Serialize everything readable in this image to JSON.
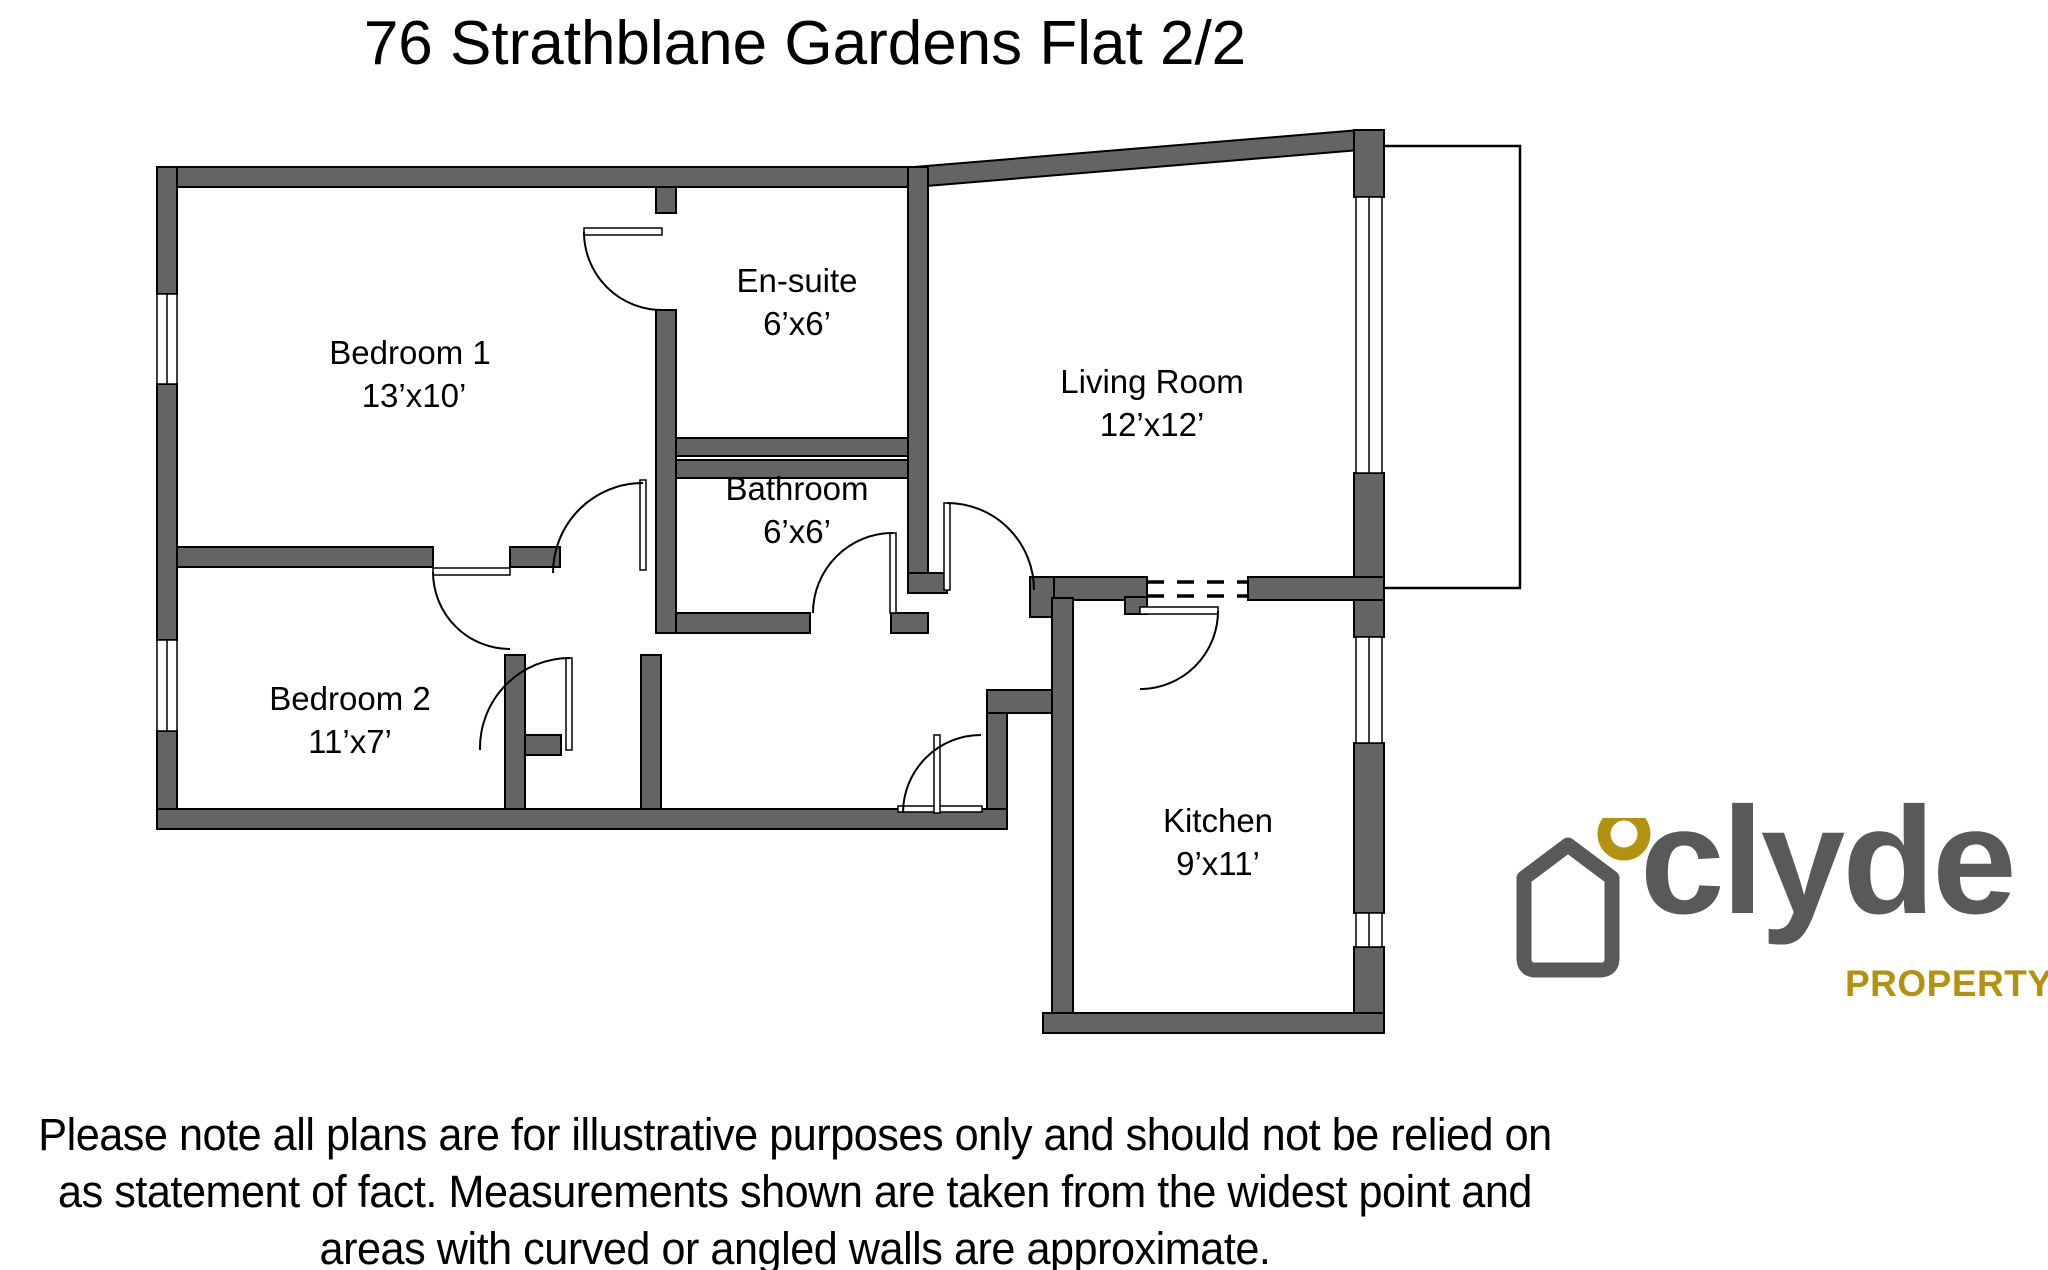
{
  "title": "76 Strathblane Gardens Flat 2/2",
  "floorplan": {
    "rooms": [
      {
        "name": "Bedroom 1",
        "size": "13’x10’"
      },
      {
        "name": "En-suite",
        "size": "6’x6’"
      },
      {
        "name": "Bathroom",
        "size": "6’x6’"
      },
      {
        "name": "Living Room",
        "size": "12’x12’"
      },
      {
        "name": "Bedroom 2",
        "size": "11’x7’"
      },
      {
        "name": "Kitchen",
        "size": "9’x11’"
      }
    ],
    "wall_color": "#646464"
  },
  "logo": {
    "brand": "clyde",
    "tagline": "PROPERTY",
    "gray": "#58595b",
    "gold": "#b3920f"
  },
  "disclaimer": {
    "lines": [
      "Please note all plans are for illustrative purposes only and should not be relied on",
      "as statement of fact. Measurements shown are taken from the widest point and",
      "areas with curved or angled walls are approximate."
    ]
  }
}
